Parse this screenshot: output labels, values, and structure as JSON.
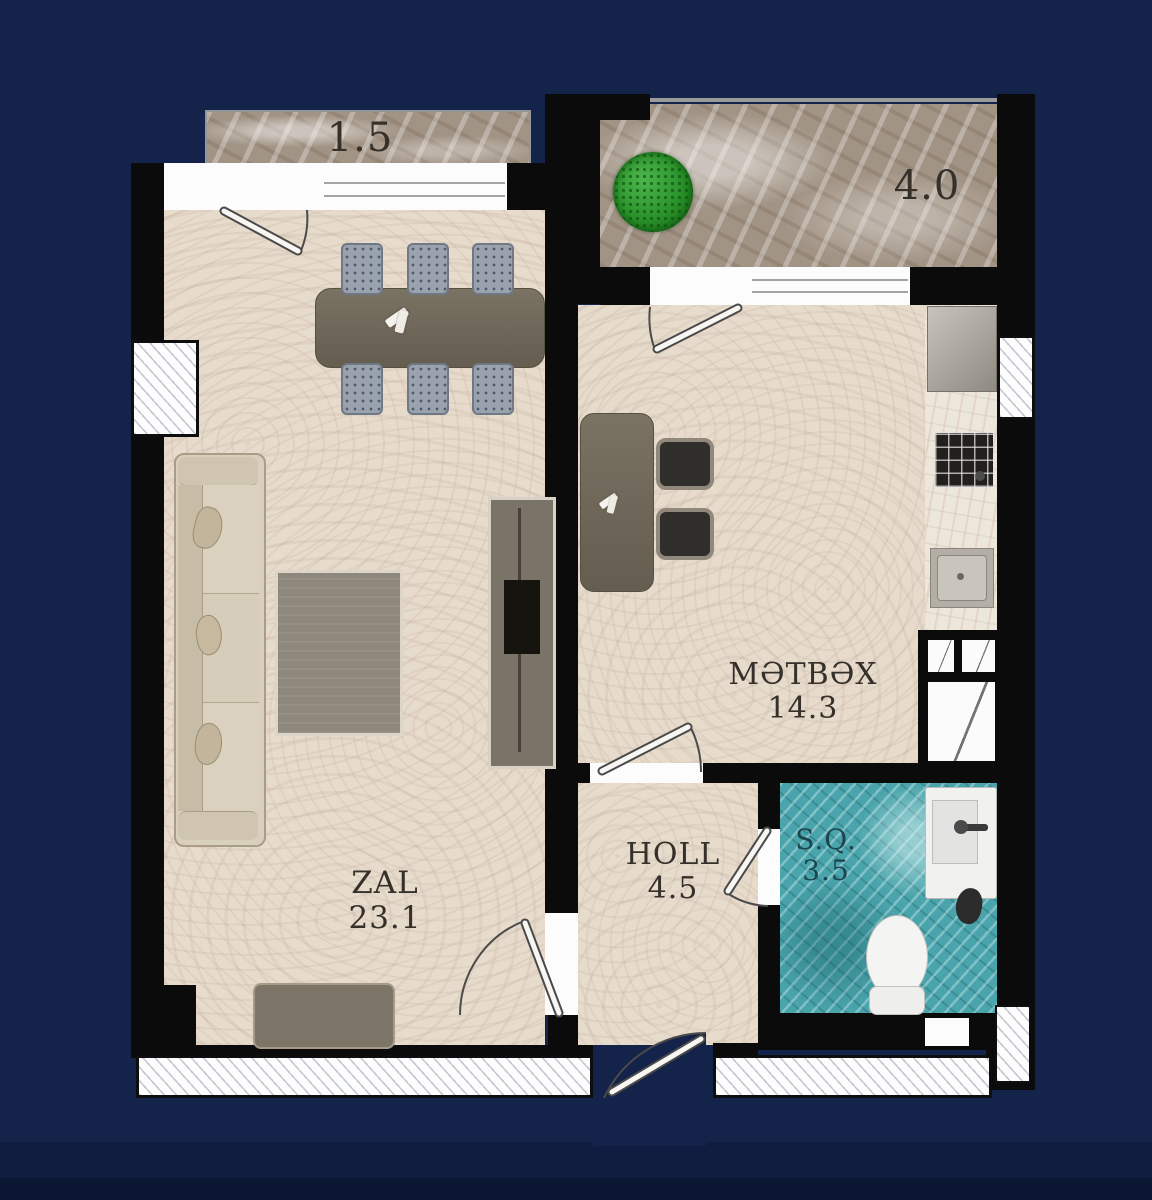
{
  "title": "Apartment floor plan",
  "rooms": {
    "zal": {
      "name": "ZAL",
      "area": "23.1"
    },
    "metbex": {
      "name": "MƏTBƏX",
      "area": "14.3"
    },
    "holl": {
      "name": "HOLL",
      "area": "4.5"
    },
    "sq": {
      "name": "S.Q.",
      "area": "3.5"
    },
    "balcony_left": {
      "area": "1.5"
    },
    "balcony_right": {
      "area": "4.0"
    }
  },
  "colors": {
    "background_navy": "#132349",
    "wall_black": "#0b0b0b",
    "floor_beige": "#e7dbcc",
    "balcony_stone": "#a29485",
    "bathroom_teal": "#4aa4ab",
    "label_dark": "#35302a",
    "bathroom_label": "#1d4550",
    "plant_green": "#2f9e2f"
  },
  "furniture": {
    "living": [
      "dining-table",
      "six-chairs",
      "sofa",
      "rug",
      "tv-unit",
      "console-bench"
    ],
    "kitchen": [
      "breakfast-table",
      "two-chairs",
      "fridge",
      "stove",
      "sink",
      "vent-shaft"
    ],
    "bathroom": [
      "wash-basin",
      "toilet"
    ],
    "balcony_right": [
      "plant"
    ]
  }
}
